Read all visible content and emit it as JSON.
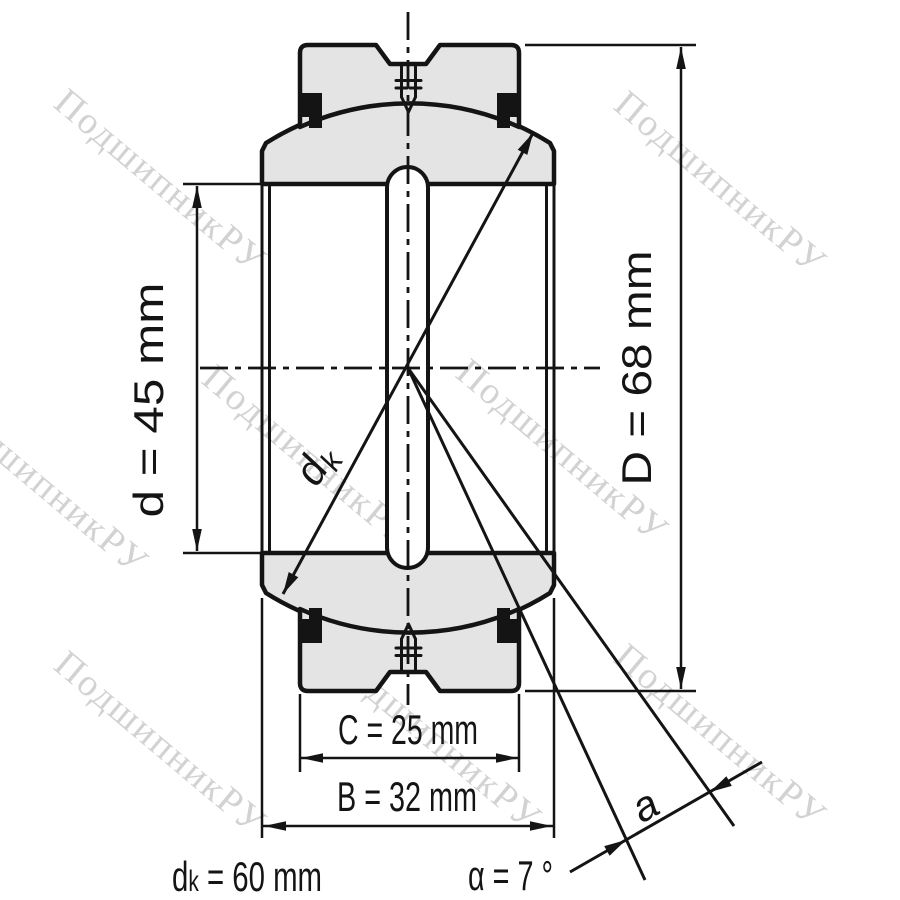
{
  "watermark": {
    "text": "ПодшипникРУ",
    "rotation": 40,
    "color": "#d2d2d2",
    "instances": [
      {
        "x": 52,
        "y": 106
      },
      {
        "x": 612,
        "y": 108
      },
      {
        "x": -66,
        "y": 408
      },
      {
        "x": 200,
        "y": 382
      },
      {
        "x": 454,
        "y": 376
      },
      {
        "x": 52,
        "y": 668
      },
      {
        "x": 327,
        "y": 664
      },
      {
        "x": 612,
        "y": 661
      }
    ]
  },
  "dimensions": {
    "bore_diameter": {
      "label": "d = 45 mm"
    },
    "outer_diameter": {
      "label": "D = 68 mm"
    },
    "outer_ring_width": {
      "label": "C = 25 mm"
    },
    "inner_ring_width": {
      "label": "B = 32 mm"
    },
    "sphere_diameter": {
      "symbol": "d",
      "subscript": "k",
      "value": " = 60 mm"
    },
    "tilt_angle": {
      "label": "α = 7 °"
    },
    "sphere_arrow_label": {
      "symbol": "d",
      "subscript": "k"
    },
    "angle_arrow_label": {
      "label": "a"
    }
  },
  "colors": {
    "line": "#141414",
    "section_fill": "#e4e4e4",
    "seal_fill": "#141414",
    "watermark": "#d2d2d2",
    "background": "#ffffff"
  }
}
